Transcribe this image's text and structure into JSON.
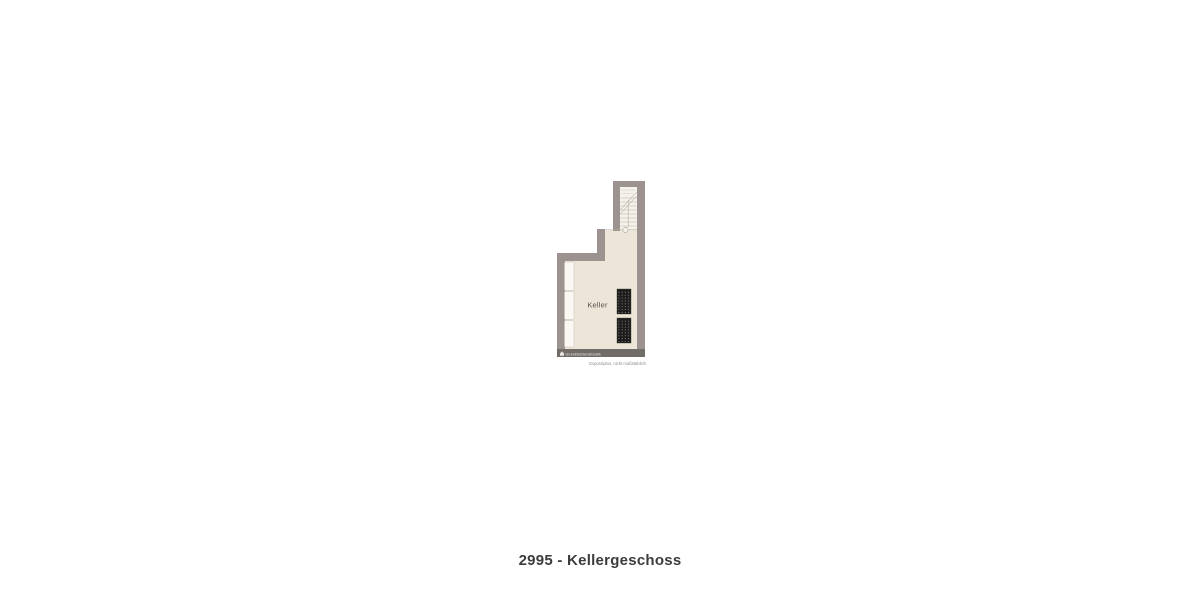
{
  "caption": "2995 - Kellergeschoss",
  "floorplan": {
    "room_label": "Keller",
    "watermark_text": "GrundrissDienstGrafik",
    "disclaimer": "Exposéplan, nicht maßstäblich"
  },
  "colors": {
    "wall": "#9c9391",
    "floor": "#ede5d8",
    "stair_floor": "#f5f2eb",
    "window_strip": "#faf8f3",
    "storage_unit": "#1d1c1a",
    "watermark_bar": "#6f6a65",
    "caption_text": "#3c3c3c"
  }
}
